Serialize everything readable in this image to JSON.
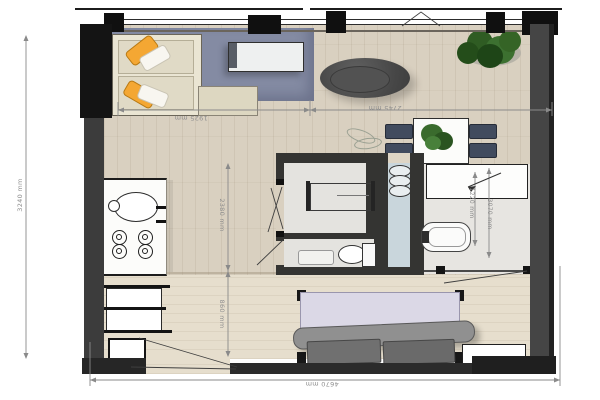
{
  "title": "studio-apartment-floor-plan",
  "dimensions": {
    "living_width": "1925 mm",
    "dining_width": "2745 mm",
    "overall_width": "4670 mm",
    "overall_height": "3240 mm",
    "corridor_upper": "2380 mm",
    "corridor_lower": "860 mm",
    "bath_inner": "1220 mm",
    "bath_outer": "3070 mm"
  },
  "colors": {
    "floor_wood": "#d9d0c0",
    "floor_wood_south": "#e6decd",
    "rug_blue": "#848ba3",
    "wall_dark": "#2f2f2f",
    "accent_orange": "#f4a733",
    "plant_green": "#3a6b2d",
    "mattress_lavender": "#dbd8e6",
    "wet_floor_blue": "#c9d6dc",
    "bath_floor": "#e4e3df",
    "dimension_gray": "#8e8e8e"
  },
  "furniture": [
    "sofa",
    "orange-pillows",
    "coffee-table",
    "area-rug",
    "round-pouf",
    "potted-plant",
    "dining-table",
    "dining-chairs",
    "table-plant",
    "washing-machine",
    "shower-bench",
    "toilet",
    "bath-mat",
    "bathtub",
    "wardrobe",
    "kitchen-sink",
    "cooktop",
    "kitchen-counter",
    "storage-cabinets",
    "sofa-bed",
    "low-shelf"
  ]
}
